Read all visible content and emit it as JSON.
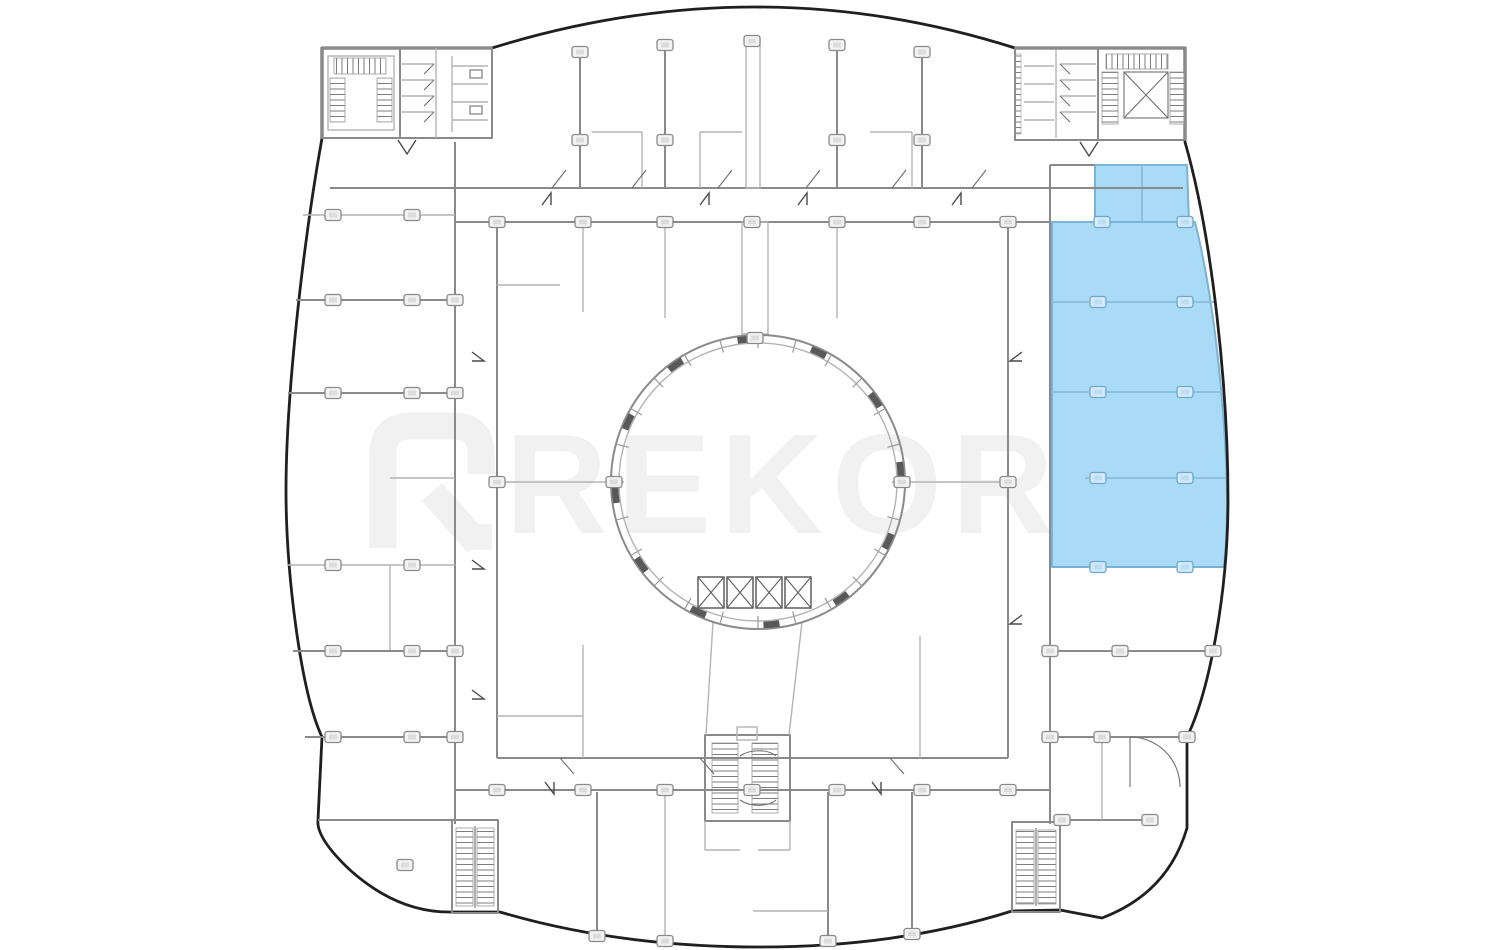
{
  "watermark": {
    "text": "REKORB",
    "color": "#f1f1f1"
  },
  "highlighted_unit": {
    "state": "selected"
  },
  "palette": {
    "background": "#ffffff",
    "outline": "#1f1f1f",
    "wall_medium": "#8a8a8a",
    "wall_light": "#b3b3b3",
    "detail": "#6f6f6f",
    "column_fill": "#f2f2f2",
    "highlight_fill": "#a9dbf6",
    "highlight_stroke": "#79b3d6",
    "highlight_wall": "#8cc0de",
    "watermark": "#f1f1f1"
  }
}
